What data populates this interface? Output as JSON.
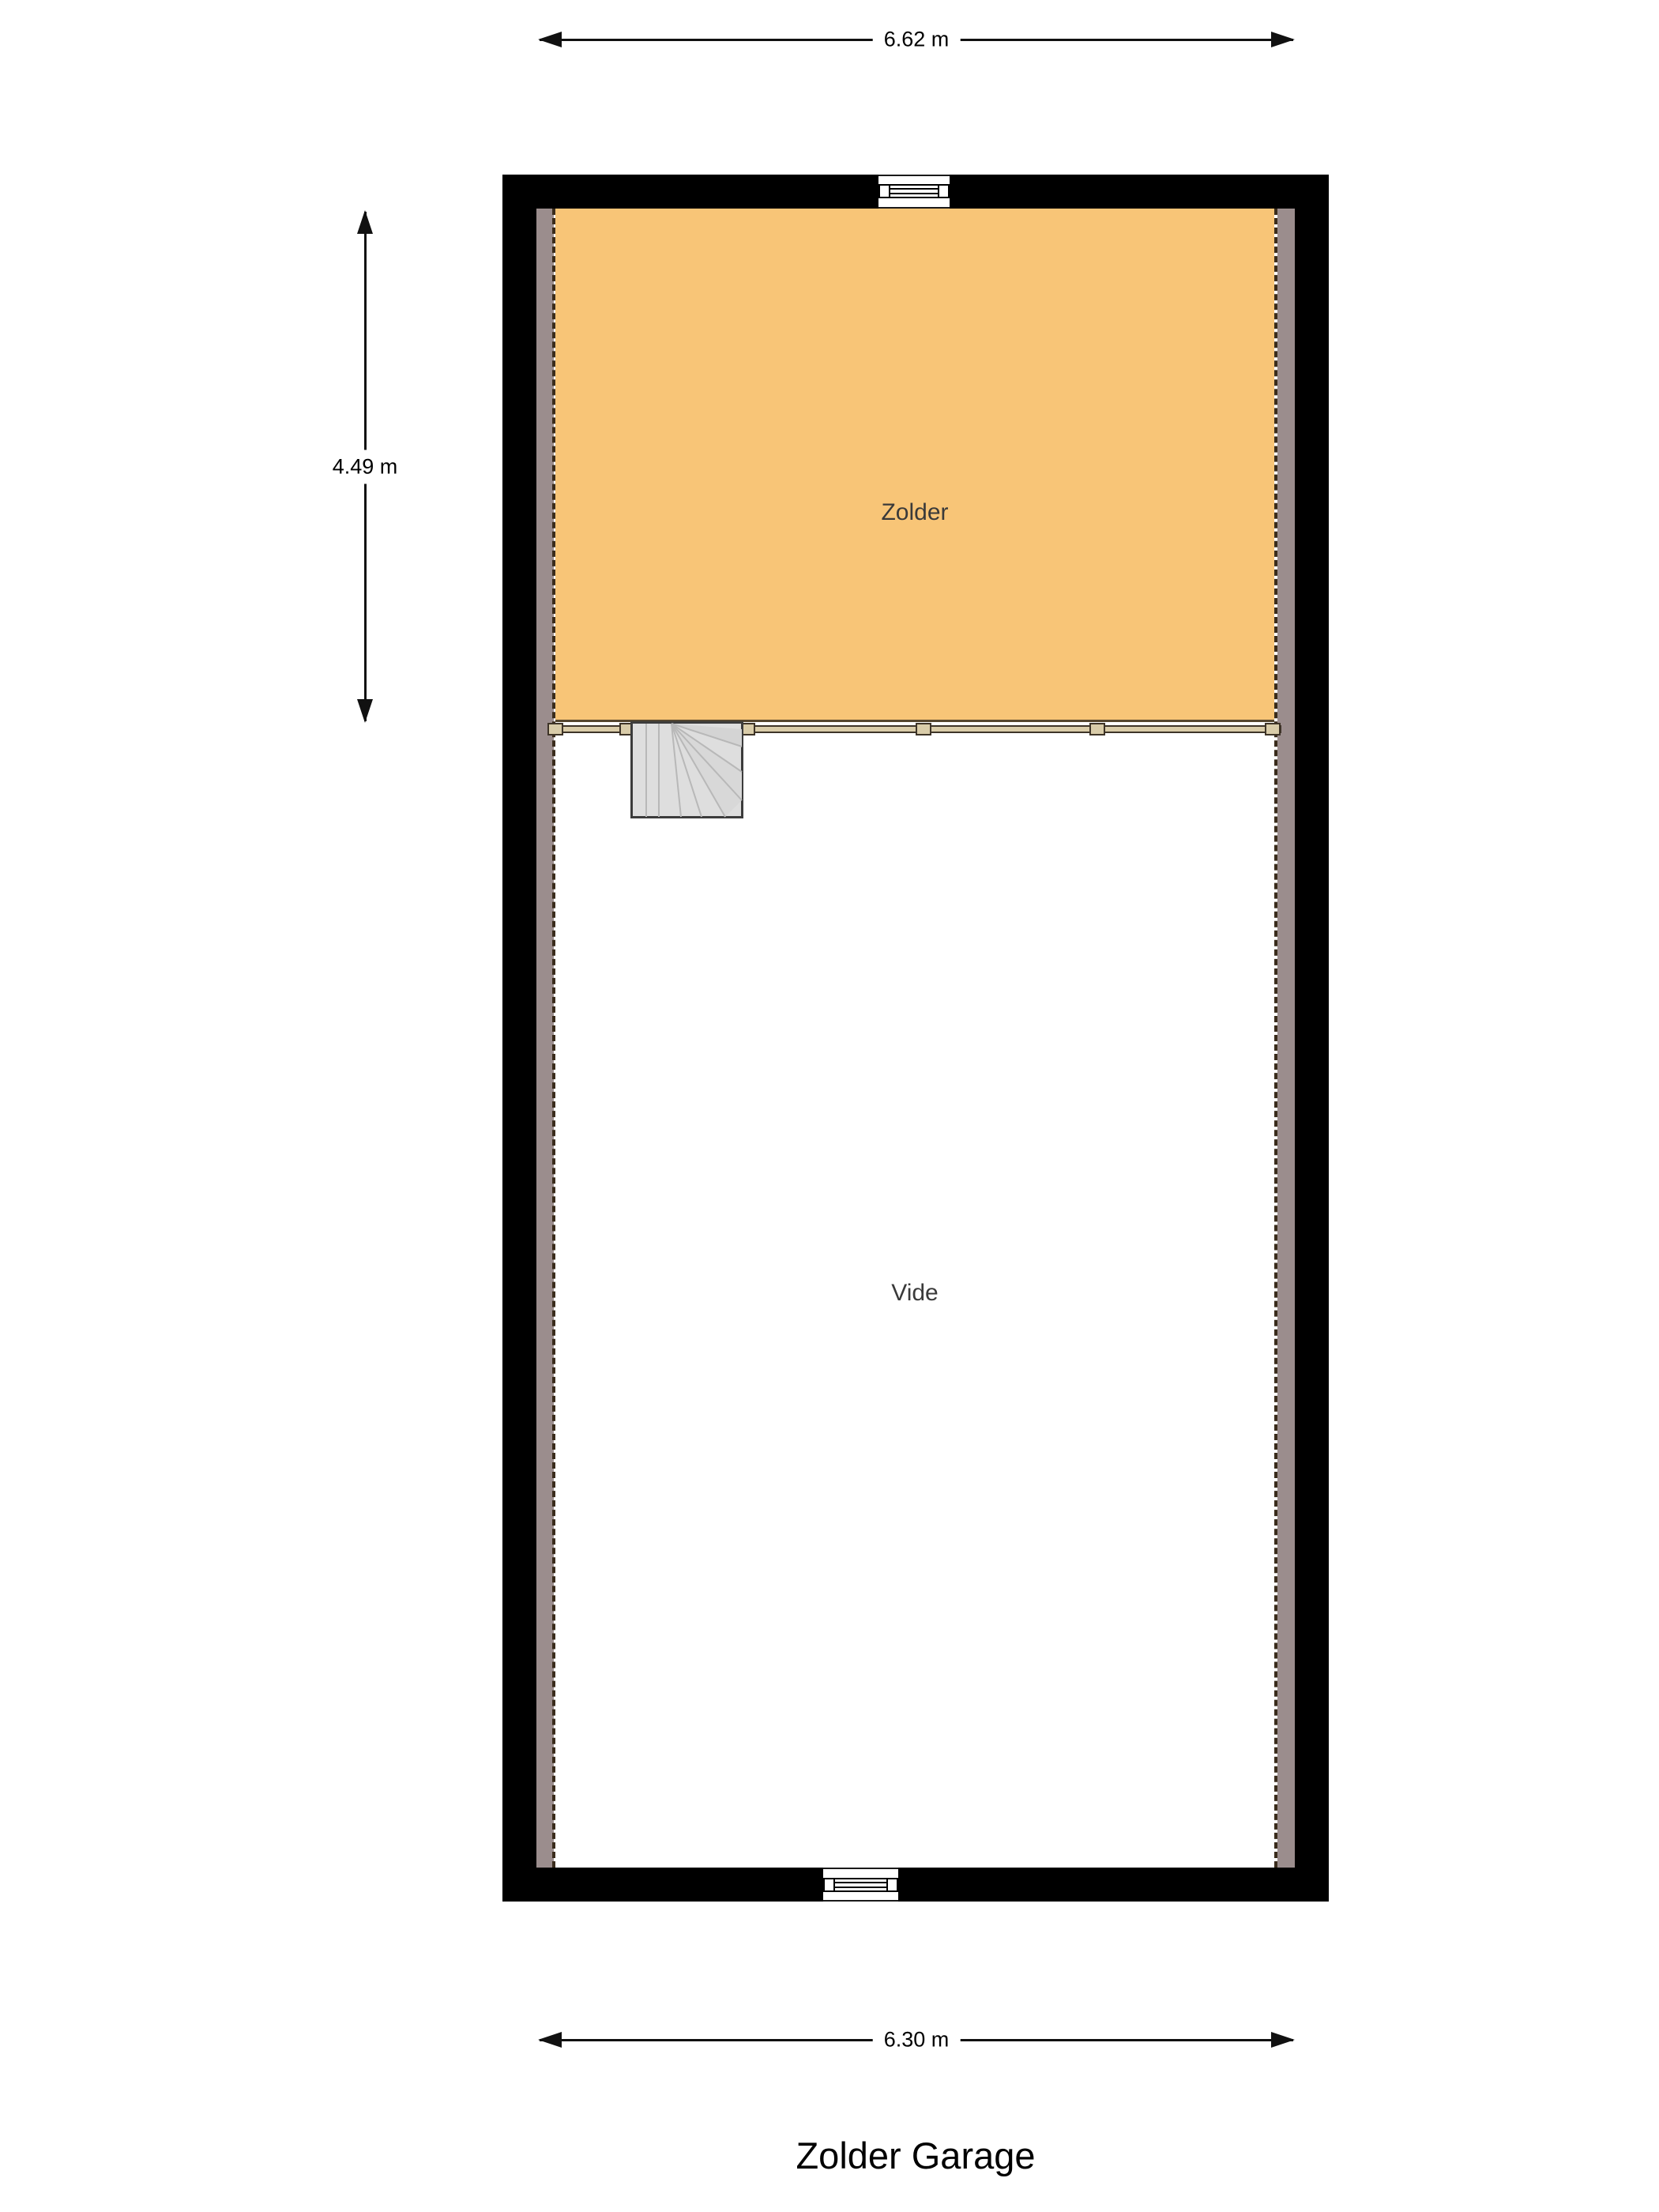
{
  "title": "Zolder Garage",
  "rooms": {
    "zolder": "Zolder",
    "vide": "Vide"
  },
  "dimensions": {
    "top": "6.62 m",
    "left": "4.49 m",
    "bottom": "6.30 m"
  },
  "colors": {
    "wall": "#000000",
    "floor_zolder": "#f8c577",
    "floor_vide": "#ffffff",
    "lowroof": "#9b8d8d",
    "dash": "#3a2c1c",
    "railing": "#d9cca9",
    "railing_border": "#3e3428",
    "stair_fill": "#dedede",
    "stair_border": "#3c3c3c",
    "stair_tread": "#b8b8b8",
    "dim": "#111111",
    "label": "#3a3a3a",
    "zolder_edge": "#55462e"
  }
}
